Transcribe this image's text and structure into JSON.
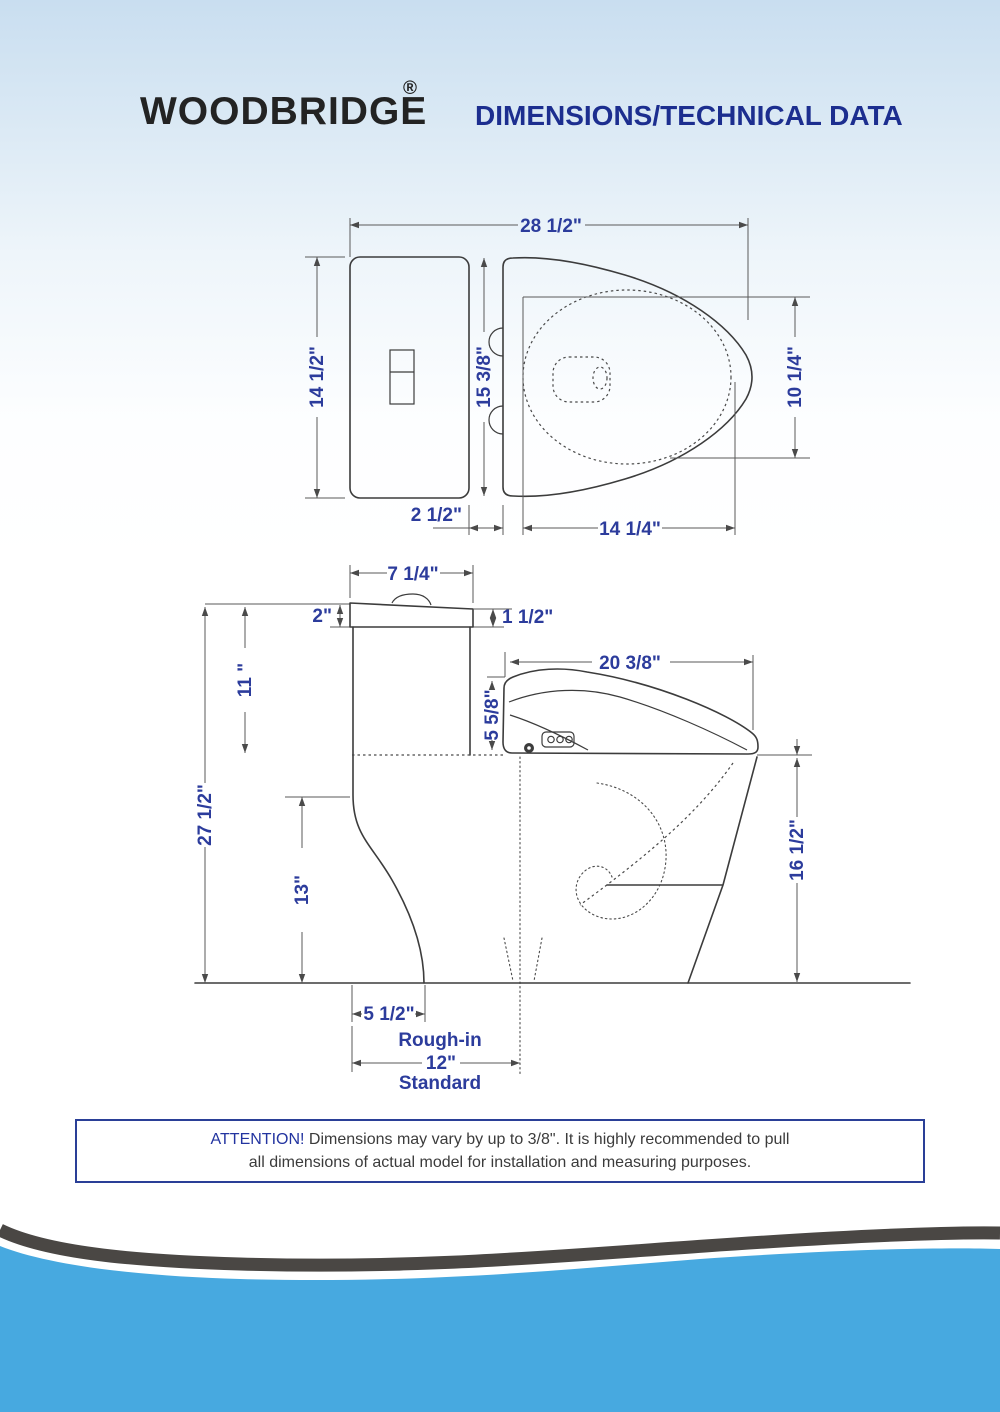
{
  "header": {
    "brand": "WOODBRIDGE",
    "registered_mark": "®",
    "title": "DIMENSIONS/TECHNICAL DATA"
  },
  "top_view": {
    "overall_length": "28 1/2\"",
    "tank_width": "14 1/2\"",
    "seat_lid_length": "15 3/8\"",
    "bowl_inner_width": "10 1/4\"",
    "tank_seat_gap": "2 1/2\"",
    "bowl_inner_length": "14 1/4\""
  },
  "side_view": {
    "tank_lid_depth": "7 1/4\"",
    "lid_back_height": "2\"",
    "lid_front_height": "1 1/2\"",
    "tank_height": "11 \"",
    "seat_length": "20  3/8\"",
    "seat_height": "5 5/8\"",
    "overall_height": "27 1/2\"",
    "bowl_side_height": "13\"",
    "rim_height": "16 1/2\"",
    "base_offset": "5 1/2\"",
    "rough_in_label": "Rough-in",
    "rough_in_value": "12\"",
    "rough_in_note": "Standard"
  },
  "attention": {
    "highlight": "ATTENTION!",
    "line1": "Dimensions may vary by up to 3/8\". It is highly recommended to pull",
    "line2": "all dimensions of actual model for installation and measuring purposes."
  },
  "colors": {
    "dimension_text": "#2c3c9c",
    "title_text": "#1c2e8f",
    "drawing_line": "#3c3c3c",
    "wave_blue": "#47a9e0",
    "wave_dark": "#4a4744",
    "background_top": "#c9def0"
  }
}
